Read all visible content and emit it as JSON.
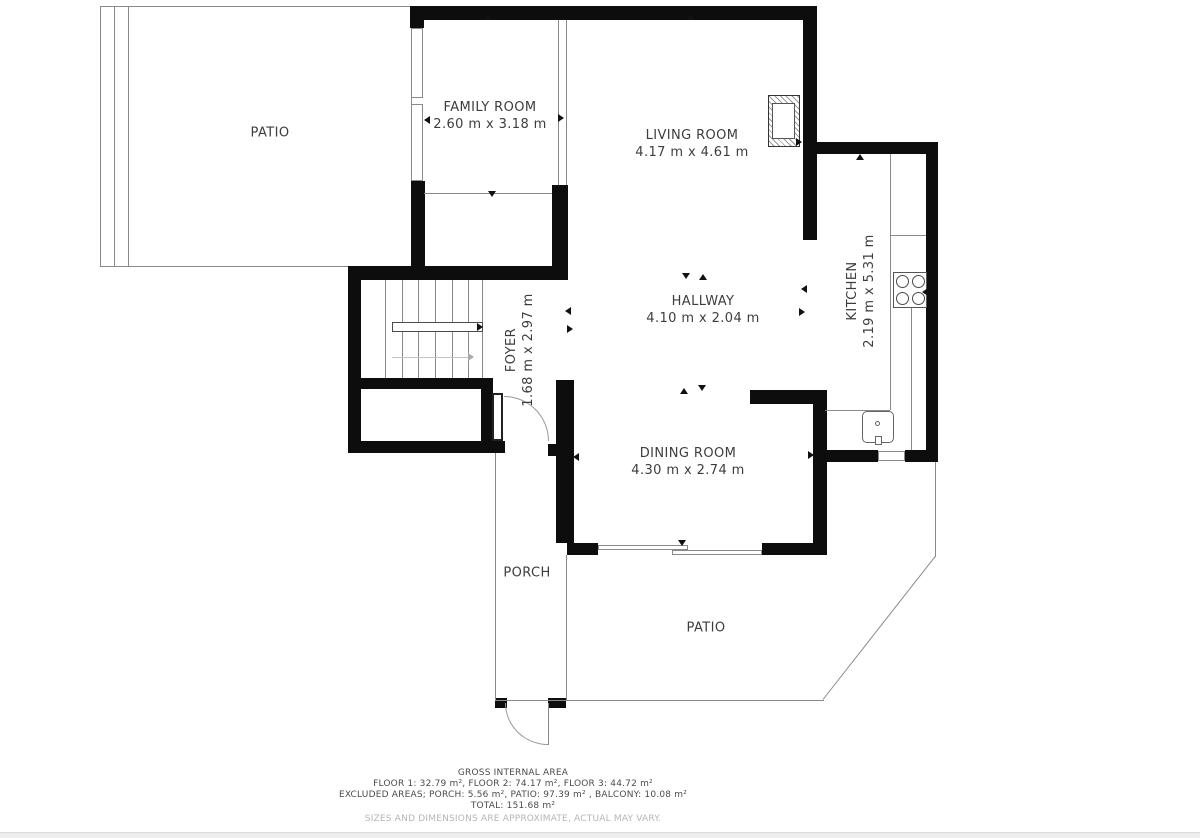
{
  "rooms": {
    "patio_top": {
      "name": "PATIO",
      "dims": ""
    },
    "family": {
      "name": "FAMILY ROOM",
      "dims": "2.60 m x 3.18 m"
    },
    "living": {
      "name": "LIVING ROOM",
      "dims": "4.17 m x 4.61 m"
    },
    "hallway": {
      "name": "HALLWAY",
      "dims": "4.10 m x 2.04 m"
    },
    "kitchen": {
      "name": "KITCHEN",
      "dims": "2.19 m x 5.31 m"
    },
    "foyer": {
      "name": "FOYER",
      "dims": "1.68 m x 2.97 m"
    },
    "dining": {
      "name": "DINING ROOM",
      "dims": "4.30 m x 2.74 m"
    },
    "porch": {
      "name": "PORCH",
      "dims": ""
    },
    "patio_bottom": {
      "name": "PATIO",
      "dims": ""
    }
  },
  "footer": {
    "title": "GROSS INTERNAL AREA",
    "line1": "FLOOR 1: 32.79 m², FLOOR 2: 74.17 m², FLOOR 3: 44.72 m²",
    "line2": "EXCLUDED AREAS; PORCH: 5.56 m², PATIO: 97.39 m² , BALCONY: 10.08 m²",
    "line3": "TOTAL: 151.68 m²",
    "disclaimer": "SIZES AND DIMENSIONS ARE APPROXIMATE, ACTUAL MAY VARY."
  },
  "features": [
    "fireplace",
    "stove",
    "sink",
    "staircase",
    "entry-door",
    "porch-door",
    "sliding-door"
  ],
  "colors": {
    "wall": "#0d0d0d",
    "thin_line": "#8a8a8a",
    "label_text": "#3d3d3d",
    "footer_text": "#4c4c4c",
    "disclaimer_text": "#b5b5b5"
  }
}
